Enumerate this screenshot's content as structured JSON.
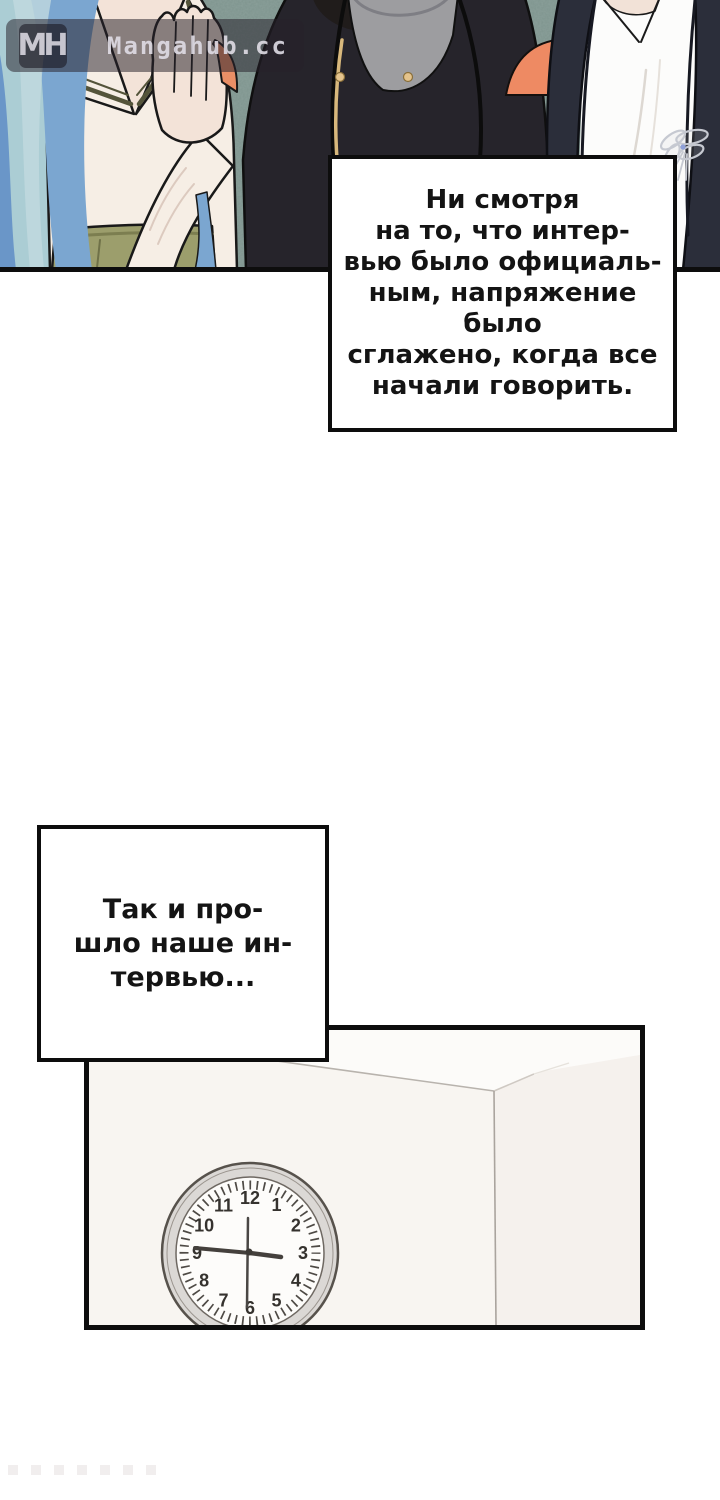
{
  "watermark": {
    "logo_text": "MH",
    "site_name": "Mangahub.cc"
  },
  "narration_box_1": {
    "lines": [
      "Ни смотря",
      "на то, что интер-",
      "вью было официаль-",
      "ным, напряжение было",
      "сглажено, когда все",
      "начали говорить."
    ]
  },
  "narration_box_2": {
    "lines": [
      "Так и про-",
      "шло наше ин-",
      "тервью..."
    ]
  },
  "clock": {
    "numbers": [
      "1",
      "2",
      "3",
      "4",
      "5",
      "6",
      "7",
      "8",
      "9",
      "10",
      "11",
      "12"
    ],
    "hour_hand_points_toward": "3",
    "minute_hand_points_toward": "9",
    "second_hand_points_toward": "6"
  },
  "colors": {
    "panel_border": "#0d0d0d",
    "speech_text": "#141414",
    "wall_background": "#7e948e",
    "hair_blue": "#7ba6d0",
    "hair_pale": "#abcdd4",
    "blouse_cream": "#f6eee5",
    "skirt_olive": "#9c9e6c",
    "skin_tone": "#f3e3d8",
    "leather_jacket": "#26242b",
    "tshirt_gray": "#9d9da0",
    "blazer_navy": "#2b2e3a",
    "shirt_white": "#fcfcfb",
    "couch_orange": "#ee8a63",
    "zipper_gold": "#d8b87c",
    "brooch_silver": "#c6c9d1",
    "clock_rim_gray": "#dbd8d5",
    "watermark_text": "#dedbe4"
  }
}
